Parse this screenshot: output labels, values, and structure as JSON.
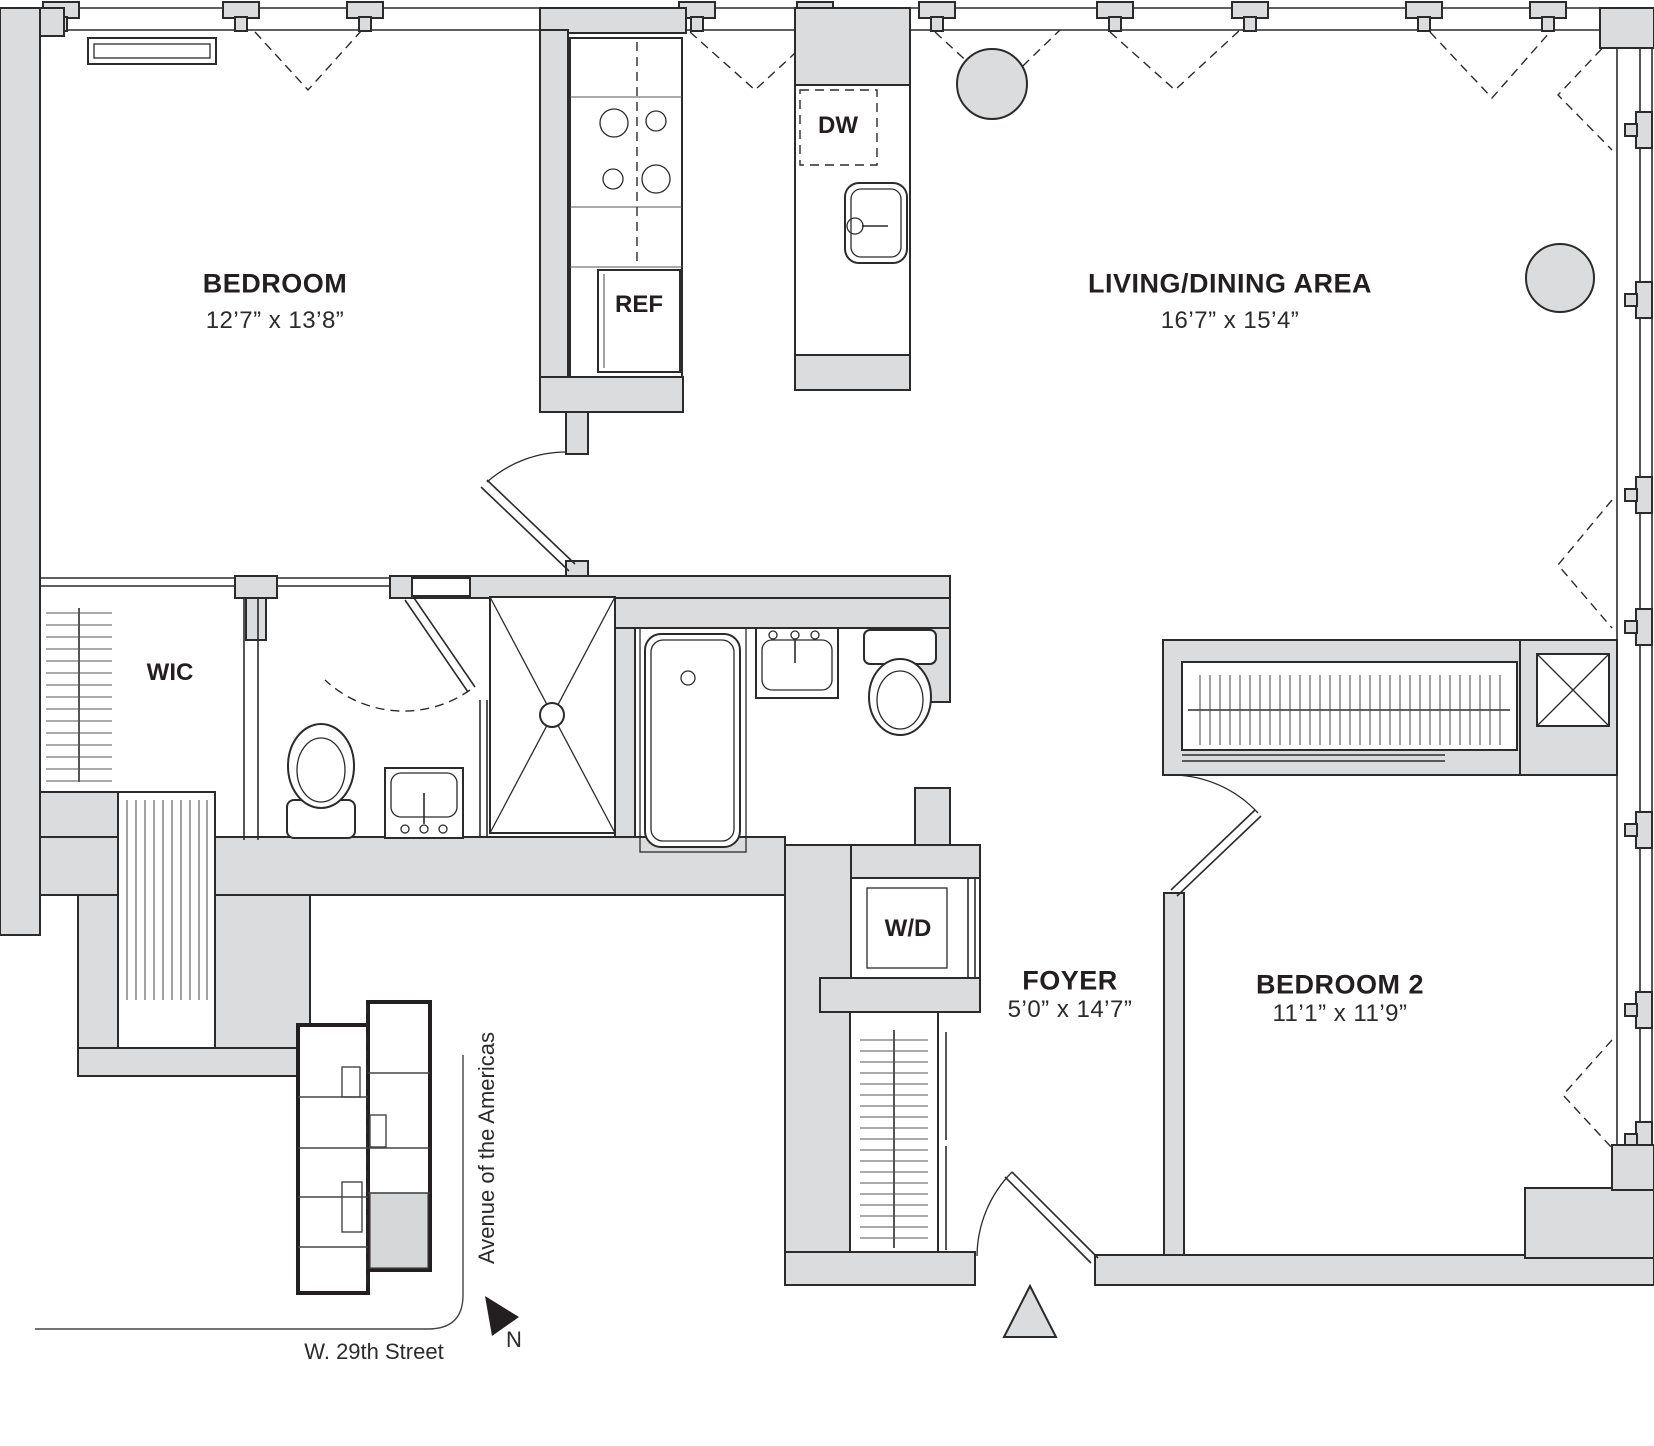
{
  "labels": {
    "bedroom": {
      "name": "BEDROOM",
      "dims": "12’7” x 13’8”"
    },
    "living": {
      "name": "LIVING/DINING AREA",
      "dims": "16’7” x 15’4”"
    },
    "wic": {
      "name": "WIC"
    },
    "ref": {
      "name": "REF"
    },
    "dw": {
      "name": "DW"
    },
    "wd": {
      "name": "W/D"
    },
    "foyer": {
      "name": "FOYER",
      "dims": "5’0” x 14’7”"
    },
    "bedroom2": {
      "name": "BEDROOM 2",
      "dims": "11’1” x 11’9”"
    },
    "keyplan": {
      "avenue": "Avenue of the Americas",
      "street": "W. 29th Street",
      "north": "N"
    }
  },
  "colors": {
    "background": "#ffffff",
    "wall_fill": "#dbdcdd",
    "line": "#2b2b2b",
    "key_unit_highlight": "#d6d7d8",
    "text": "#231f20"
  }
}
